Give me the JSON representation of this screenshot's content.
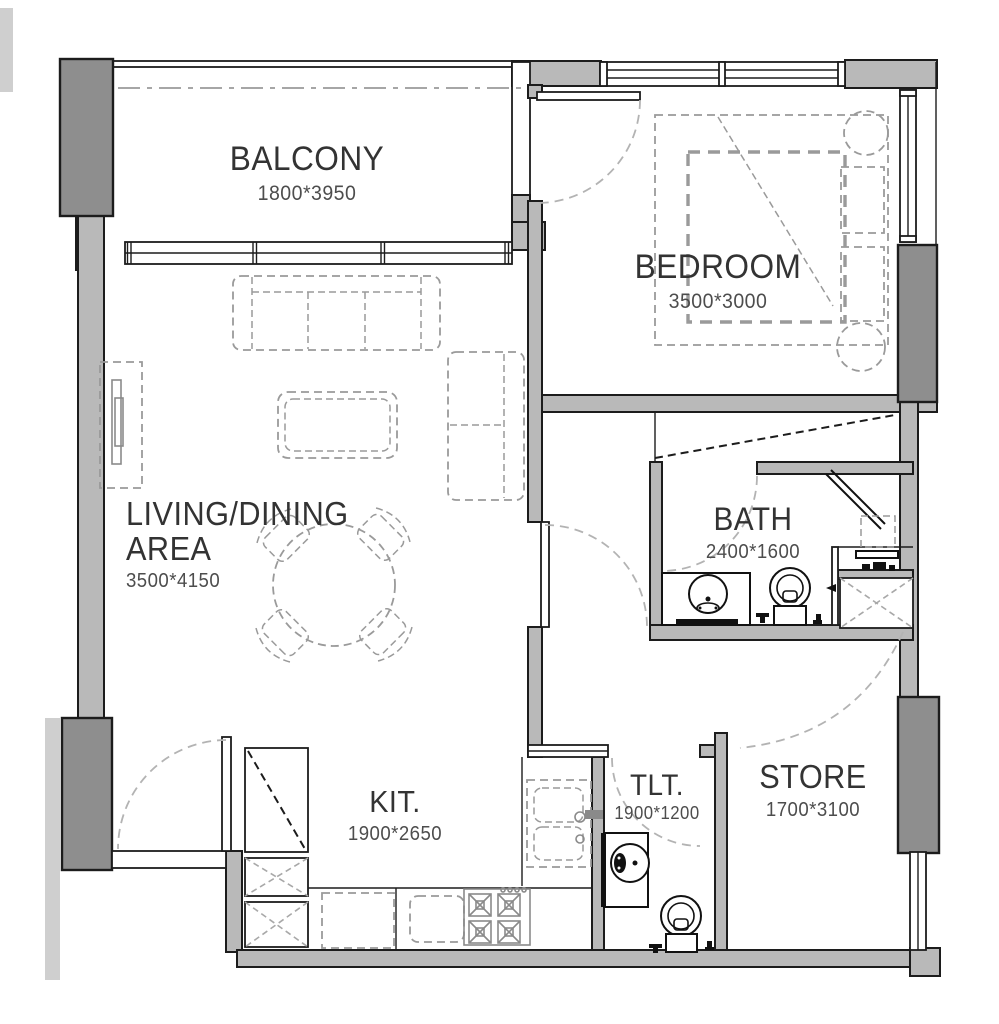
{
  "rooms": {
    "balcony": {
      "name": "BALCONY",
      "dims": "1800*3950"
    },
    "bedroom": {
      "name": "BEDROOM",
      "dims": "3500*3000"
    },
    "living_dining": {
      "name_line1": "LIVING/DINING",
      "name_line2": "AREA",
      "dims": "3500*4150"
    },
    "bath": {
      "name": "BATH",
      "dims": "2400*1600"
    },
    "kitchen": {
      "name": "KIT.",
      "dims": "1900*2650"
    },
    "toilet": {
      "name": "TLT.",
      "dims": "1900*1200"
    },
    "store": {
      "name": "STORE",
      "dims": "1700*3100"
    }
  },
  "colors": {
    "background": "#ffffff",
    "line": "#1c1c1c",
    "wall_fill": "#b9b9b9",
    "column_fill": "#8e8e8e",
    "exterior_fill": "#cfcfcf",
    "furniture_line": "#9a9a9a",
    "fixture_line": "#111111",
    "room_text": "#333333",
    "dim_text": "#4d4d4d"
  }
}
